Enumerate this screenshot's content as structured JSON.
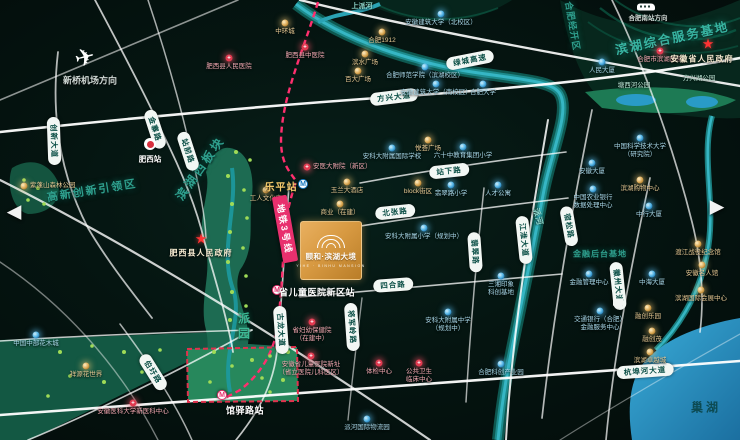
{
  "logo": {
    "title": "颐和·滨湖大境",
    "subtitle": "YIHE · BINHU MANSION"
  },
  "transport": {
    "airport": {
      "label": "新桥机场方向",
      "x": 85,
      "y": 58,
      "lx": 90,
      "ly": 80
    },
    "rail_hub": {
      "label": "合肥南站方向",
      "x": 646,
      "y": 7,
      "lx": 648,
      "ly": 17
    }
  },
  "labels": [
    {
      "t": "高新创新引领区",
      "x": 92,
      "y": 190,
      "r": -9,
      "cls": "l-zone",
      "fs": 11,
      "ls": 2
    },
    {
      "t": "滨湖西板块",
      "x": 200,
      "y": 168,
      "r": -55,
      "cls": "l-zone",
      "fs": 12,
      "ls": 3
    },
    {
      "t": "合肥经开区",
      "x": 573,
      "y": 26,
      "r": 80,
      "cls": "l-zone",
      "fs": 9,
      "ls": 1
    },
    {
      "t": "滨湖综合服务基地",
      "x": 672,
      "y": 37,
      "r": -12,
      "cls": "l-zonebig",
      "fs": 12.5,
      "ls": 2
    },
    {
      "t": "金融后台基地",
      "x": 600,
      "y": 254,
      "r": 0,
      "cls": "l-zone",
      "fs": 8,
      "ls": 1
    },
    {
      "t": "上派河",
      "x": 362,
      "y": 6,
      "r": 0,
      "cls": "l-water",
      "fs": 7,
      "ls": 0
    },
    {
      "t": "派河",
      "x": 538,
      "y": 217,
      "r": 75,
      "cls": "l-water",
      "fs": 8,
      "ls": 1
    },
    {
      "t": "巢湖",
      "x": 706,
      "y": 407,
      "r": 0,
      "cls": "l-lake",
      "fs": 12,
      "ls": 3
    },
    {
      "t": "塘西河公园",
      "x": 634,
      "y": 84,
      "r": 0,
      "cls": "l-park",
      "fs": 6.5,
      "ls": 0
    },
    {
      "t": "方兴湖公园",
      "x": 699,
      "y": 77,
      "r": 0,
      "cls": "l-park",
      "fs": 6.5,
      "ls": 0
    },
    {
      "t": "派园",
      "x": 244,
      "y": 327,
      "r": 0,
      "cls": "l-parkv",
      "fs": 12,
      "ls": 3
    }
  ],
  "road_pills": [
    {
      "t": "创新大道",
      "x": 54,
      "y": 141,
      "r": 88
    },
    {
      "t": "金寨路",
      "x": 155,
      "y": 129,
      "r": 72
    },
    {
      "t": "站前路",
      "x": 188,
      "y": 151,
      "r": 72
    },
    {
      "t": "方兴大道",
      "x": 394,
      "y": 97,
      "r": -7
    },
    {
      "t": "绿城高速",
      "x": 470,
      "y": 60,
      "r": -11
    },
    {
      "t": "站下路",
      "x": 449,
      "y": 171,
      "r": -6
    },
    {
      "t": "北张路",
      "x": 395,
      "y": 212,
      "r": -6
    },
    {
      "t": "四合路",
      "x": 393,
      "y": 285,
      "r": -4
    },
    {
      "t": "杭埠河大道",
      "x": 645,
      "y": 371,
      "r": -4
    },
    {
      "t": "江淮大道",
      "x": 524,
      "y": 240,
      "r": 84
    },
    {
      "t": "宿松路",
      "x": 569,
      "y": 226,
      "r": 80
    },
    {
      "t": "徽州大道",
      "x": 618,
      "y": 286,
      "r": 84
    },
    {
      "t": "翡翠路",
      "x": 475,
      "y": 252,
      "r": 86
    },
    {
      "t": "古龙大道",
      "x": 281,
      "y": 330,
      "r": 86
    },
    {
      "t": "将军岭路",
      "x": 352,
      "y": 327,
      "r": 86
    },
    {
      "t": "伯圩路",
      "x": 153,
      "y": 372,
      "r": 58
    }
  ],
  "metro": {
    "line_name": "地铁3号线",
    "lx": 285,
    "ly": 229,
    "lr": 80,
    "stations": [
      {
        "name": "乐平站",
        "style": "gold",
        "tx": 281,
        "ty": 186,
        "ix": 303,
        "iy": 184
      },
      {
        "name": "省儿童医院新区站",
        "style": "white",
        "tx": 317,
        "ty": 292,
        "ix": 277,
        "iy": 290
      },
      {
        "name": "馆驿路站",
        "style": "white",
        "tx": 245,
        "ty": 410,
        "ix": 222,
        "iy": 395
      }
    ]
  },
  "rail_stations": [
    {
      "name": "肥西站",
      "x": 150,
      "y": 144,
      "lx": 150,
      "ly": 159
    }
  ],
  "government": [
    {
      "name": "安徽省人民政府",
      "x": 708,
      "y": 44,
      "lx": 702,
      "ly": 59
    },
    {
      "name": "肥西县人民政府",
      "x": 201,
      "y": 239,
      "lx": 201,
      "ly": 253
    }
  ],
  "pois": [
    {
      "t": "中环城",
      "x": 285,
      "y": 23,
      "c": "g"
    },
    {
      "t": "肥西县中医院",
      "x": 305,
      "y": 47,
      "c": "r"
    },
    {
      "t": "合肥1912",
      "x": 382,
      "y": 32,
      "c": "g"
    },
    {
      "t": "滨水广场",
      "x": 365,
      "y": 54,
      "c": "g"
    },
    {
      "t": "百大广场",
      "x": 358,
      "y": 71,
      "c": "g"
    },
    {
      "t": "安徽建筑大学（北校区）",
      "x": 441,
      "y": 14,
      "c": "b"
    },
    {
      "t": "合肥师范学院（滨湖校区）",
      "x": 425,
      "y": 67,
      "c": "b"
    },
    {
      "t": "安徽建筑大学（南校区）",
      "x": 436,
      "y": 84,
      "c": "b"
    },
    {
      "t": "合肥大学",
      "x": 483,
      "y": 84,
      "c": "b"
    },
    {
      "t": "肥西县人民医院",
      "x": 229,
      "y": 58,
      "c": "r"
    },
    {
      "t": "合肥市滨湖医院",
      "x": 660,
      "y": 51,
      "c": "r"
    },
    {
      "t": "人民大厦",
      "x": 602,
      "y": 62,
      "c": "b"
    },
    {
      "t": "紫蓬山森林公园",
      "x": 24,
      "y": 186,
      "c": "g",
      "side": "r"
    },
    {
      "t": "安医大附院（新区）",
      "x": 307,
      "y": 167,
      "c": "r",
      "side": "r"
    },
    {
      "t": "玉兰大酒店",
      "x": 347,
      "y": 182,
      "c": "g"
    },
    {
      "t": "block街区",
      "x": 418,
      "y": 183,
      "c": "g"
    },
    {
      "t": "悦荟广场",
      "x": 428,
      "y": 140,
      "c": "g"
    },
    {
      "t": "安科大附属国际学校",
      "x": 392,
      "y": 148,
      "c": "b"
    },
    {
      "t": "六十中教育集团小学",
      "x": 463,
      "y": 147,
      "c": "b"
    },
    {
      "t": "翡翠路小学",
      "x": 451,
      "y": 185,
      "c": "b"
    },
    {
      "t": "人才公寓",
      "x": 498,
      "y": 185,
      "c": "b"
    },
    {
      "t": "商业（在建）",
      "x": 340,
      "y": 204,
      "c": "g"
    },
    {
      "t": "工人文化宫",
      "x": 266,
      "y": 190,
      "c": "g"
    },
    {
      "t": "安科大附属小学（规划中）",
      "x": 424,
      "y": 228,
      "c": "b"
    },
    {
      "t": "三湘印象",
      "t2": "科创基地",
      "x": 501,
      "y": 276,
      "c": "b"
    },
    {
      "t": "省妇幼保健院",
      "t2": "（在建中）",
      "x": 312,
      "y": 322,
      "c": "r"
    },
    {
      "t": "安徽省儿童医院新址",
      "t2": "（省立医院儿科医区）",
      "x": 311,
      "y": 356,
      "c": "r"
    },
    {
      "t": "体检中心",
      "x": 379,
      "y": 363,
      "c": "r"
    },
    {
      "t": "公共卫生",
      "t2": "临床中心",
      "x": 419,
      "y": 363,
      "c": "r"
    },
    {
      "t": "安科大附属中学",
      "t2": "（规划中）",
      "x": 448,
      "y": 312,
      "c": "b"
    },
    {
      "t": "交通银行（合肥）",
      "t2": "金融服务中心",
      "x": 600,
      "y": 311,
      "c": "b"
    },
    {
      "t": "合肥科创产业园",
      "x": 501,
      "y": 364,
      "c": "b"
    },
    {
      "t": "派河国际物流园",
      "x": 367,
      "y": 419,
      "c": "b"
    },
    {
      "t": "中国中部花木城",
      "x": 36,
      "y": 335,
      "c": "b"
    },
    {
      "t": "祥源花世界",
      "x": 86,
      "y": 366,
      "c": "g"
    },
    {
      "t": "安徽医科大学新医科中心",
      "x": 133,
      "y": 403,
      "c": "r"
    },
    {
      "t": "中国科学技术大学",
      "t2": "（研究院）",
      "x": 640,
      "y": 138,
      "c": "b"
    },
    {
      "t": "安徽大厦",
      "x": 592,
      "y": 163,
      "c": "b"
    },
    {
      "t": "中国农业银行",
      "t2": "数据处理中心",
      "x": 593,
      "y": 189,
      "c": "b"
    },
    {
      "t": "滨湖购物中心",
      "x": 640,
      "y": 180,
      "c": "g"
    },
    {
      "t": "中行大厦",
      "x": 649,
      "y": 206,
      "c": "b"
    },
    {
      "t": "金融管理中心",
      "x": 589,
      "y": 274,
      "c": "b"
    },
    {
      "t": "中海大厦",
      "x": 652,
      "y": 274,
      "c": "b"
    },
    {
      "t": "渡江战役纪念馆",
      "x": 698,
      "y": 244,
      "c": "g"
    },
    {
      "t": "安徽名人馆",
      "x": 702,
      "y": 265,
      "c": "g"
    },
    {
      "t": "滨湖国际会展中心",
      "x": 701,
      "y": 290,
      "c": "g"
    },
    {
      "t": "融创乐园",
      "x": 648,
      "y": 308,
      "c": "g"
    },
    {
      "t": "融创茂",
      "x": 652,
      "y": 331,
      "c": "g"
    },
    {
      "t": "滨湖卓越城",
      "x": 650,
      "y": 352,
      "c": "g"
    }
  ],
  "arrows": {
    "prev": "◀",
    "next": "▶",
    "px": 14,
    "py": 212,
    "nx": 717,
    "ny": 207
  },
  "shield": {
    "x": 618,
    "y": 304
  }
}
